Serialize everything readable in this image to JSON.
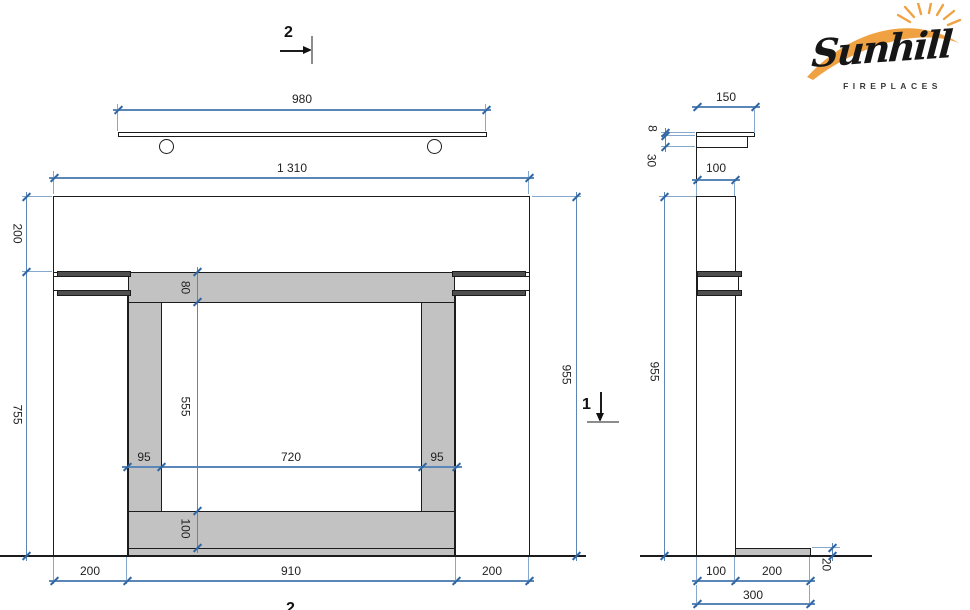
{
  "brand": {
    "name": "Sunhill",
    "tagline": "FIREPLACES"
  },
  "markers": {
    "top": "2",
    "bottom": "2",
    "side": "1"
  },
  "front": {
    "shelf_width": "980",
    "overall_width": "1 310",
    "top_band": "200",
    "pillar_height": "755",
    "total_height": "955",
    "lintel": "80",
    "opening_height": "555",
    "jamb_left": "95",
    "opening_width": "720",
    "jamb_right": "95",
    "hearth_band": "100",
    "base_left": "200",
    "base_center": "910",
    "base_right": "200"
  },
  "side": {
    "shelf_depth": "150",
    "shelf_thickness": "8",
    "apron": "30",
    "depth_top": "100",
    "total_height": "955",
    "depth_bottom": "100",
    "hearth_depth": "200",
    "hearth_thickness": "20",
    "total_depth": "300"
  },
  "colors": {
    "dimension_blue": "#5b87b8",
    "panel_gray": "#c2c2c2",
    "molding_dark": "#4f4f4f",
    "logo_orange": "#F0A243"
  }
}
